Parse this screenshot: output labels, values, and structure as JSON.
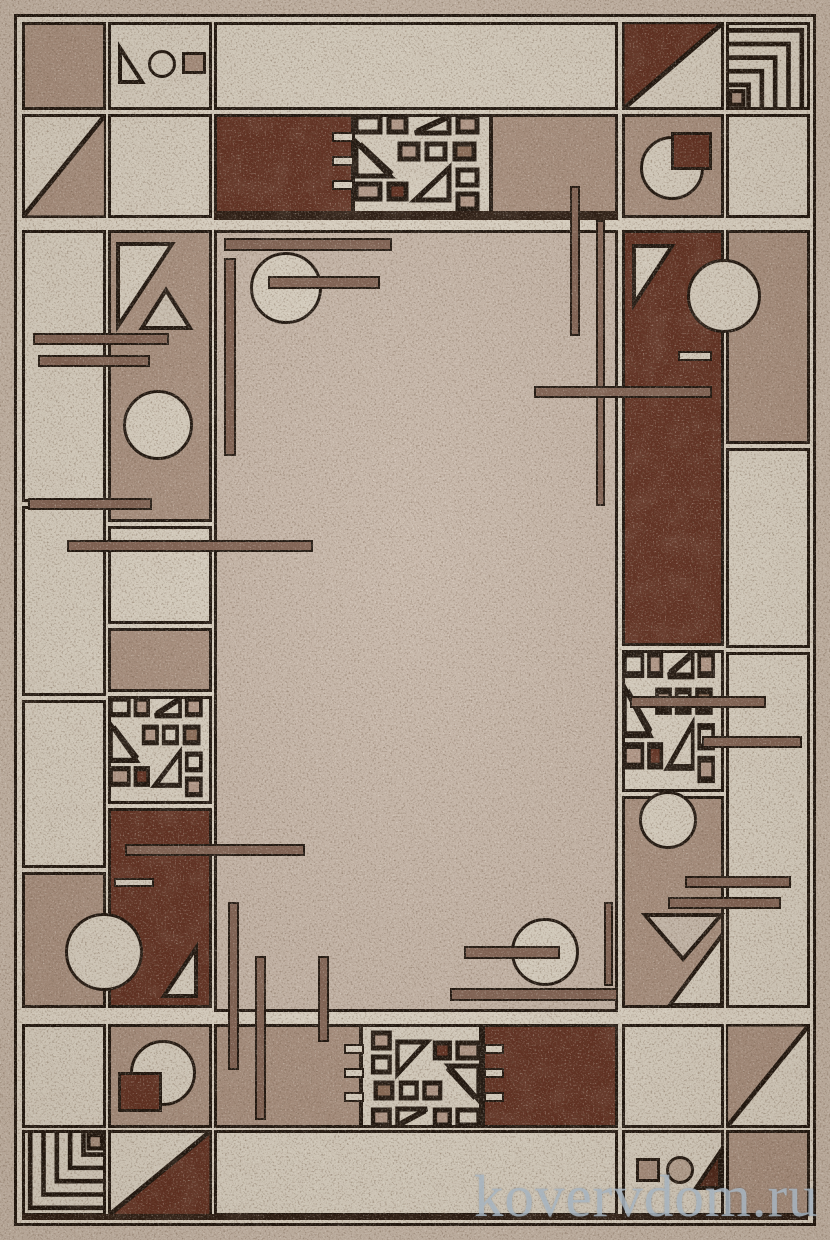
{
  "meta": {
    "description": "Product photograph of a rectangular beige-brown carpet with a geometric Frank-Lloyd-Wright-style tiled border (circles, triangles, squares, nested corner lines, thin bars) around a speckled plain center field",
    "width_px": 830,
    "height_px": 1240
  },
  "watermark": {
    "text": "kovervdom.ru"
  },
  "palette": {
    "outer": "#c6b7a8",
    "grout": "#ddd5c6",
    "light": "#d9d1c2",
    "field": "#c7b7a9",
    "mauve": "#a9907f",
    "brown": "#5f2d1e",
    "outline": "#191009",
    "bar": "#806152",
    "watermark": "rgba(172,186,199,0.8)"
  }
}
